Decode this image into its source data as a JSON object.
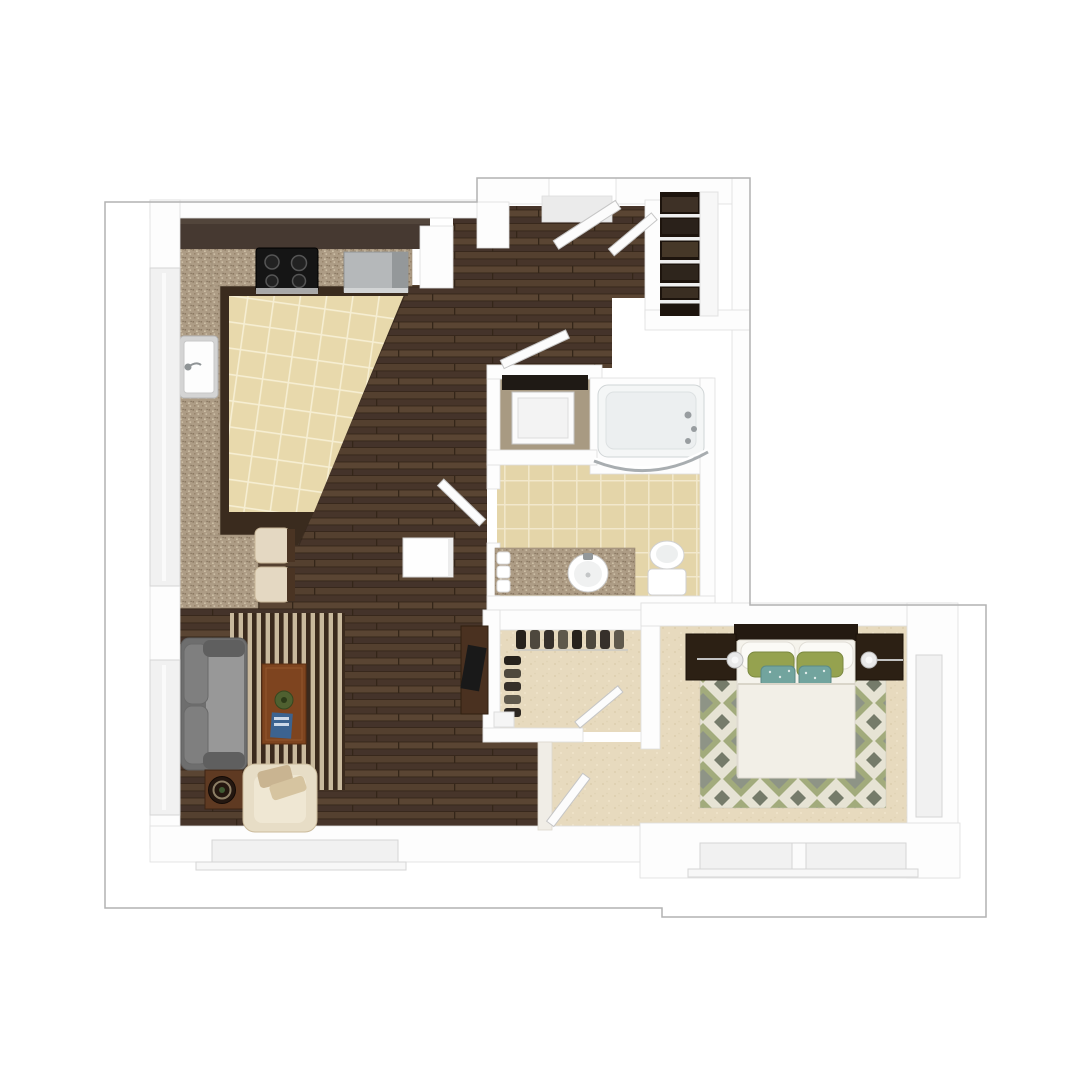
{
  "meta": {
    "type": "3d-floor-plan-top-view",
    "canvas_width": 1080,
    "canvas_height": 1080
  },
  "colors": {
    "background": "#ffffff",
    "outline": "#b2b2b2",
    "wall": "#fdfdfd",
    "window": "#f1f1f1",
    "door_leaf": "#fcfcfc",
    "wood_base": "#4c392c",
    "wood_row1": "#54402f",
    "wood_row2": "#47352a",
    "wood_row3": "#5a4533",
    "wood_row4": "#44332a",
    "wood_gap": "#342619",
    "tile_kitchen": "#e8d9ac",
    "tile_kitchen_line": "#f6eed2",
    "tile_bath": "#e4d5a9",
    "tile_bath_line": "#f2e8cc",
    "granite": "#ad9c85",
    "carpet": "#e7dabe",
    "laundry_floor": "#a89a82",
    "cabinet": "#463931",
    "base_cabinet_trim": "#3a2b1e",
    "stove": "#151515",
    "stainless": "#b5b8ba",
    "sofa_frame": "#6e6e6e",
    "sofa_seat": "#989898",
    "sofa_cushion": "#7f7f7f",
    "sofa_arm": "#5f5f5f",
    "armchair": "#e7ddc6",
    "rug_stripe_dark": "#3b2a1d",
    "rug_stripe_light": "#c9b99d",
    "coffee_table": "#7e441f",
    "plant": "#4f6030",
    "book": "#3c6390",
    "side_table": "#5f3a22",
    "tray": "#241710",
    "desk": "#4a3120",
    "headboard": "#241a11",
    "bed_linen": "#f5f3ec",
    "duvet": "#f2efe7",
    "pillow_green": "#95a24f",
    "pillow_teal": "#72a49e",
    "nightstand": "#2c2014",
    "bedrug_bg": "#e6e3d4",
    "bedrug_green": "#a2ab7c",
    "bedrug_gray": "#8e9486",
    "bedrug_dark": "#757b6a",
    "closet_dark": "#1d140d"
  },
  "scene": {
    "view": "top-down 3d render of one-bedroom apartment",
    "rooms": [
      {
        "name": "kitchen",
        "floor": "beige tile",
        "features": [
          "upper cabinets",
          "granite counters",
          "black range",
          "stainless refrigerator",
          "sink",
          "breakfast bar with 2 stools"
        ]
      },
      {
        "name": "entry",
        "floor": "hardwood",
        "features": [
          "entry door",
          "coat closet with dark shelves"
        ]
      },
      {
        "name": "laundry closet",
        "floor": "tan",
        "features": [
          "stacked washer-dryer"
        ]
      },
      {
        "name": "bathroom",
        "floor": "beige tile",
        "features": [
          "bathtub with curved glass",
          "granite vanity with oval sink",
          "toilet",
          "rolled towels"
        ]
      },
      {
        "name": "walk-in closet",
        "floor": "carpet",
        "features": [
          "hanging clothes along two walls"
        ]
      },
      {
        "name": "hallway",
        "floor": "hardwood",
        "features": [
          "white cabinet"
        ]
      },
      {
        "name": "living room",
        "floor": "hardwood",
        "features": [
          "gray sofa",
          "striped area rug",
          "coffee table with plant and blue book",
          "cream armchair with pillows",
          "round tray side table",
          "dark desk",
          "side window",
          "bottom window"
        ]
      },
      {
        "name": "bedroom",
        "floor": "carpet",
        "features": [
          "double bed with white duvet",
          "green pillows",
          "teal pillows",
          "two dark nightstands with lamps",
          "diamond-pattern area rug",
          "right window",
          "bottom window"
        ]
      }
    ],
    "window_count": 5,
    "door_count": 6
  }
}
